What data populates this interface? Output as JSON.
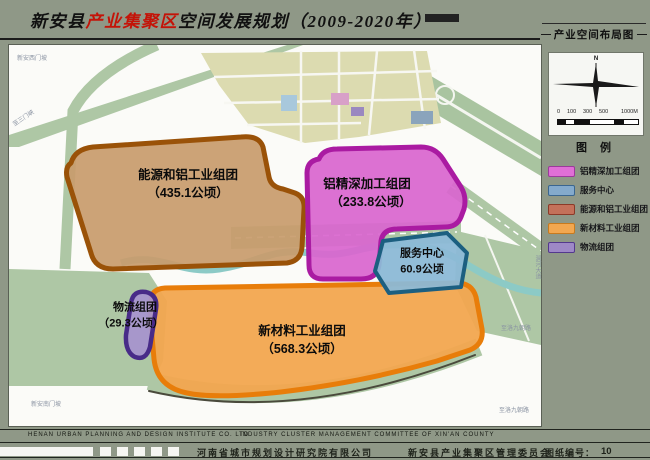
{
  "title": {
    "black1": "新安县",
    "red": "产业集聚区",
    "black2": "空间发展规划（2009-2020年）"
  },
  "sidebar": {
    "map_label": "产业空间布局图",
    "north_label": "N",
    "scale_ticks": [
      "0",
      "100",
      "300",
      "500",
      "1000M"
    ],
    "legend": {
      "title": "图 例",
      "items": [
        {
          "label": "铝精深加工组团",
          "fill": "#e06fd6",
          "border": "#9c3a9c"
        },
        {
          "label": "服务中心",
          "fill": "#84aacc",
          "border": "#3a6690"
        },
        {
          "label": "能源和铝工业组团",
          "fill": "#c4715a",
          "border": "#8c3a28"
        },
        {
          "label": "新材料工业组团",
          "fill": "#f2a750",
          "border": "#c87a1e"
        },
        {
          "label": "物流组团",
          "fill": "#9e88c6",
          "border": "#54388e"
        }
      ]
    }
  },
  "map": {
    "zones": [
      {
        "name": "能源和铝工业组团",
        "area": "（435.1公顷）",
        "fill": "#c89c6d",
        "border": "#9a5208"
      },
      {
        "name": "铝精深加工组团",
        "area": "（233.8公顷）",
        "fill": "#d966cf",
        "border": "#aa1ba2"
      },
      {
        "name": "服务中心",
        "area": "60.9公顷",
        "fill": "#8cb9d6",
        "border": "#1c5f80"
      },
      {
        "name": "物流组团",
        "area": "（29.3公顷）",
        "fill": "#a795cc",
        "border": "#482b88"
      },
      {
        "name": "新材料工业组团",
        "area": "（568.3公顷）",
        "fill": "#f2a64f",
        "border": "#e87d0a"
      }
    ],
    "annotations": [
      {
        "text": "新安西门坡"
      },
      {
        "text": "至三门峡"
      },
      {
        "text": "新安南门坡"
      },
      {
        "text": "至洛九朝路"
      },
      {
        "text": "至洛九朝路"
      },
      {
        "text": "涧河大道"
      }
    ]
  },
  "footer": {
    "en_left": "HENAN  URBAN  PLANNING  AND  DESIGN  INSTITUTE  CO.  LTD",
    "en_right": "INDUSTRY CLUSTER MANAGEMENT COMMITTEE OF XIN'AN COUNTY",
    "cn_left": "河南省城市规划设计研究院有限公司",
    "cn_right": "新安县产业集聚区管理委员会",
    "sheet_label": "图纸编号：",
    "sheet_number": "10"
  }
}
